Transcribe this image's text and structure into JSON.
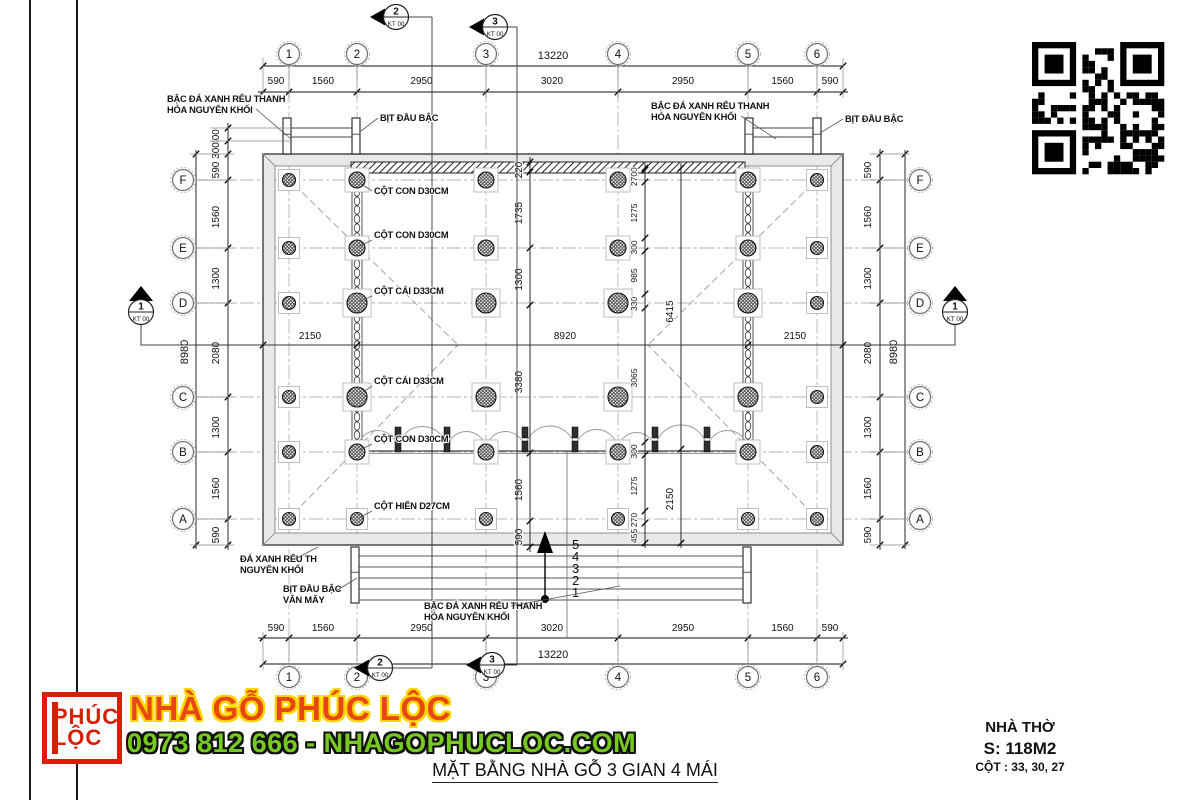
{
  "drawing": {
    "title": "MẶT BẰNG NHÀ GỖ 3 GIAN 4 MÁI",
    "grid": {
      "cols": [
        "1",
        "2",
        "3",
        "4",
        "5",
        "6"
      ],
      "rows_top_to_bottom": [
        "F",
        "E",
        "D",
        "C",
        "B",
        "A"
      ]
    },
    "dimensions": {
      "top": {
        "chain": [
          "590",
          "1560",
          "2950",
          "3020",
          "2950",
          "1560",
          "590"
        ],
        "total": "13220"
      },
      "bottom": {
        "chain": [
          "590",
          "1560",
          "2950",
          "3020",
          "2950",
          "1560",
          "590"
        ],
        "total": "13220"
      },
      "left": {
        "chain": [
          "590",
          "1560",
          "1300",
          "2080",
          "1300",
          "1560",
          "590"
        ],
        "total": "8980",
        "steps": [
          "300",
          "300"
        ]
      },
      "right": {
        "chain": [
          "590",
          "1560",
          "1300",
          "2080",
          "1300",
          "1560",
          "590"
        ],
        "total": "8980"
      },
      "inner_vertical_main": [
        "220",
        "1735",
        "1300",
        "3380",
        "1560",
        "590"
      ],
      "inner_vertical_detail": [
        "40",
        "270",
        "1275",
        "300",
        "985",
        "330",
        "3065",
        "300",
        "1275",
        "270",
        "455"
      ],
      "inner_vertical_right": [
        "6415",
        "2150"
      ],
      "inner_horizontal": [
        "2150",
        "8920",
        "2150"
      ]
    },
    "section_markers": {
      "side": {
        "num": "1",
        "sheet": "KT 00"
      },
      "v2": {
        "num": "2",
        "sheet": "KT 00"
      },
      "v3": {
        "num": "3",
        "sheet": "KT 00"
      }
    },
    "annotations": {
      "step_stone_top_left": [
        "BẬC ĐÁ XANH RÊU THANH",
        "HÓA NGUYÊN KHỐI"
      ],
      "step_cap_top_left": "BỊT ĐẦU BẬC",
      "step_stone_top_right": [
        "BẬC ĐÁ XANH RÊU THANH",
        "HÓA NGUYÊN KHỐI"
      ],
      "step_cap_top_right": "BỊT ĐẦU BẬC",
      "col_con_1": "CỘT CON D30CM",
      "col_con_2": "CỘT CON D30CM",
      "col_cai_1": "CỘT CÁI D33CM",
      "col_cai_2": "CỘT CÁI D33CM",
      "col_con_3": "CỘT CON D30CM",
      "col_hien": "CỘT HIÊN D27CM",
      "stone_bottom_left": [
        "ĐÁ XANH RÊU TH",
        "NGUYÊN KHỐI"
      ],
      "step_cap_bottom": [
        "BỊT ĐẦU BẬC",
        "VÂN MÂY"
      ],
      "step_stone_bottom": [
        "BẬC ĐÁ XANH RÊU THANH",
        "HÓA NGUYÊN KHỐI"
      ],
      "step_numbers": [
        "5",
        "4",
        "3",
        "2",
        "1"
      ]
    },
    "icons": {
      "qr": "qr-code"
    }
  },
  "footer": {
    "logo": {
      "line1": "PHÚC",
      "line2": "LỘC"
    },
    "brand": "NHÀ GỖ PHÚC LỘC",
    "contact": "0973 812 666 - NHAGOPHUCLOC.COM",
    "info": {
      "name": "NHÀ THỜ",
      "area": "S: 118M2",
      "columns": "CỘT : 33, 30, 27"
    }
  },
  "colors": {
    "brand_red": "#d81e05",
    "brand_orange_red": "#e8470f",
    "brand_yellow": "#ffd400",
    "brand_green": "#76c91e",
    "line_dark": "#1a1a1a"
  }
}
